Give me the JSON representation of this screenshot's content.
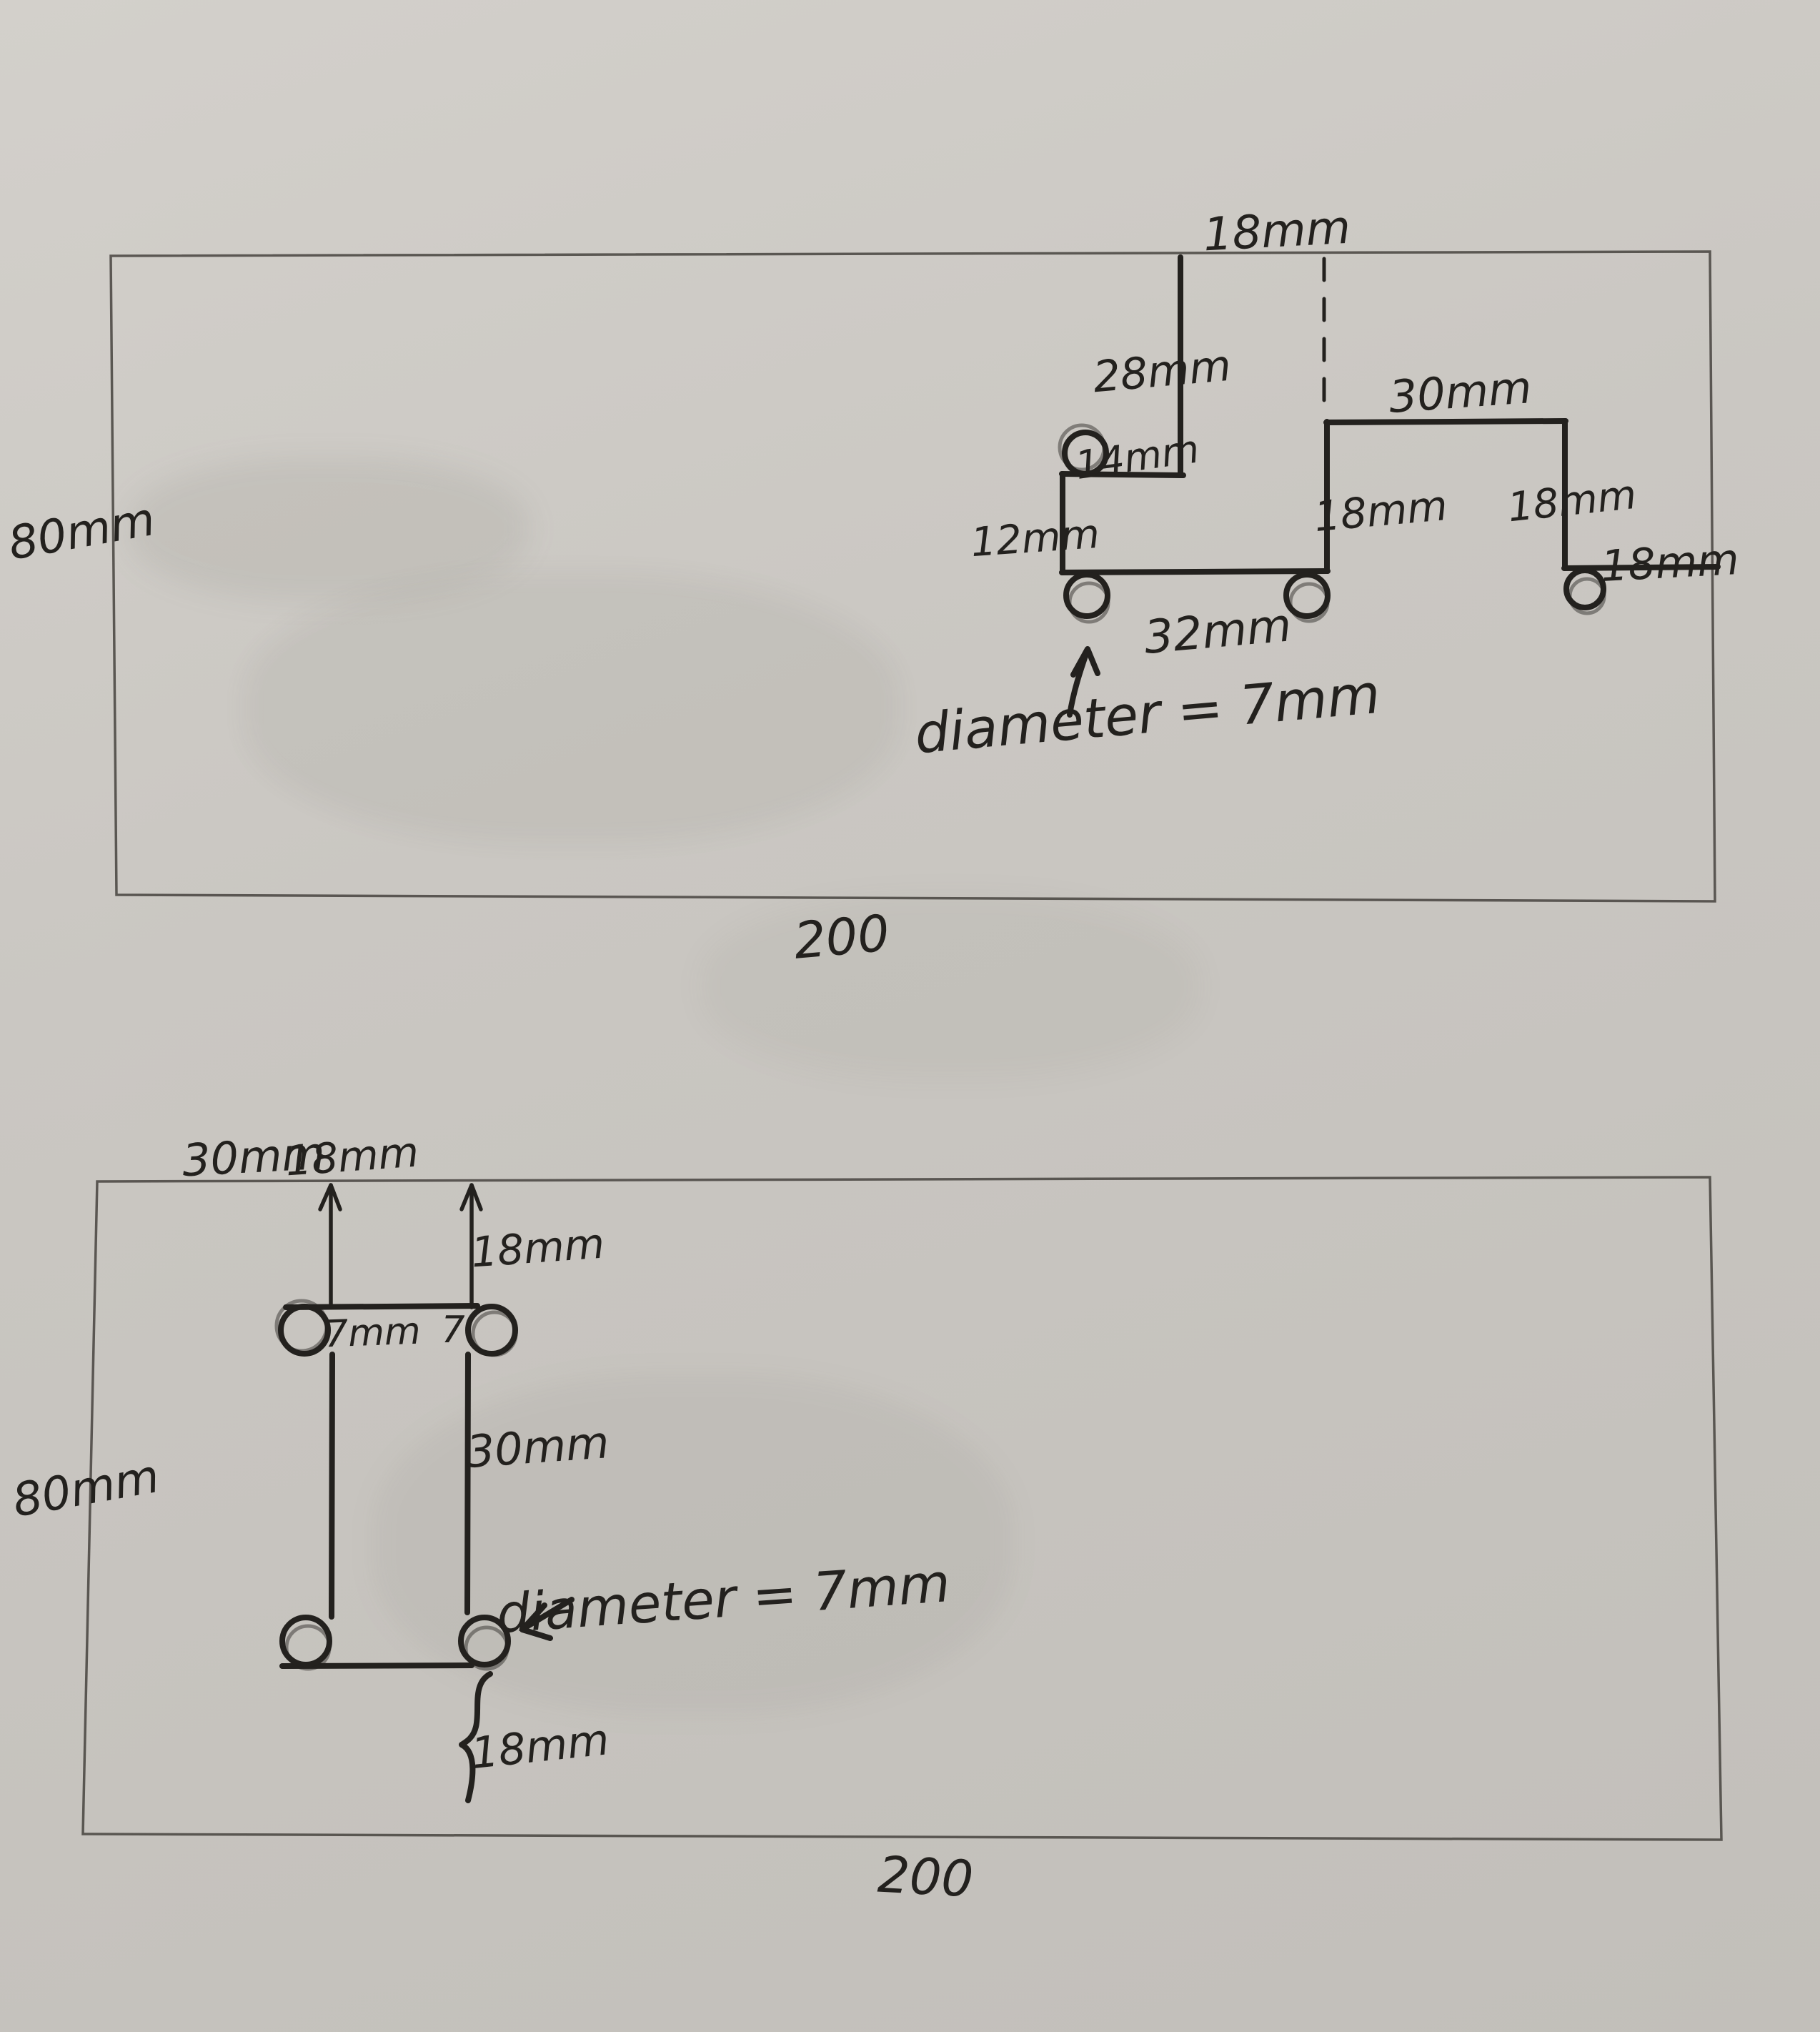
{
  "colors": {
    "paper": "#cac7c2",
    "ink": "#23211e",
    "pencil": "#4a4742"
  },
  "top_drawing": {
    "height_label": "80mm",
    "width_label": "200",
    "top_gap": "18mm",
    "notch_depth": "28mm",
    "step_width": "14mm",
    "left_edge": "12mm",
    "bottom_width": "32mm",
    "mid_rise": "18mm",
    "right_top_width": "30mm",
    "right_drop": "18mm",
    "right_end_width": "18mm",
    "diameter_note": "diameter = 7mm"
  },
  "bottom_drawing": {
    "height_label": "80mm",
    "width_label": "200",
    "left_offset": "30mm",
    "slot_width": "18mm",
    "top_offset": "18mm",
    "hole_left_label": "7mm",
    "hole_right_label": "7",
    "slot_height": "30mm",
    "diameter_note": "diameter = 7mm",
    "bottom_offset": "18mm"
  }
}
